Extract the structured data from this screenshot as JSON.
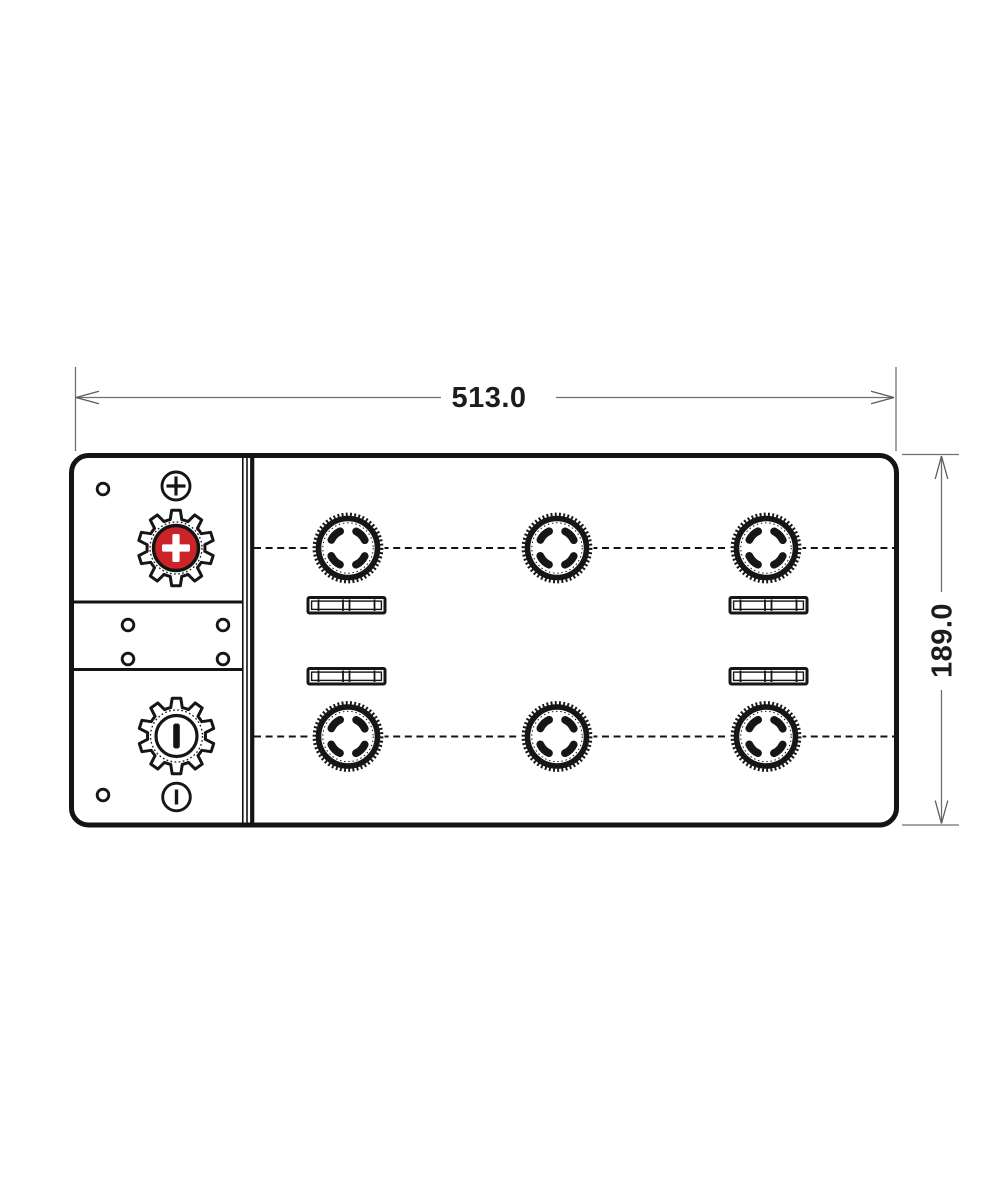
{
  "page": {
    "type": "technical-drawing",
    "subject": "battery-top-view",
    "background": "#ffffff"
  },
  "dimensions": {
    "width_label": "513.0",
    "height_label": "189.0"
  },
  "colors": {
    "line": "#161616",
    "dimension_line": "#6f6f6f",
    "positive_terminal_red": "#cc2328",
    "background": "#ffffff"
  },
  "battery": {
    "terminals": [
      {
        "polarity": "positive",
        "marking": "+"
      },
      {
        "polarity": "negative",
        "marking": "−"
      }
    ],
    "polarity_symbols": [
      {
        "symbol": "⊕",
        "position": "top-of-left-panel"
      },
      {
        "symbol": "⊖",
        "position": "bottom-of-left-panel"
      }
    ],
    "vent_caps": {
      "count": 6,
      "rows": 2,
      "columns": 3
    },
    "handle_slots": {
      "count": 4
    },
    "small_holes": {
      "count": 8
    }
  }
}
